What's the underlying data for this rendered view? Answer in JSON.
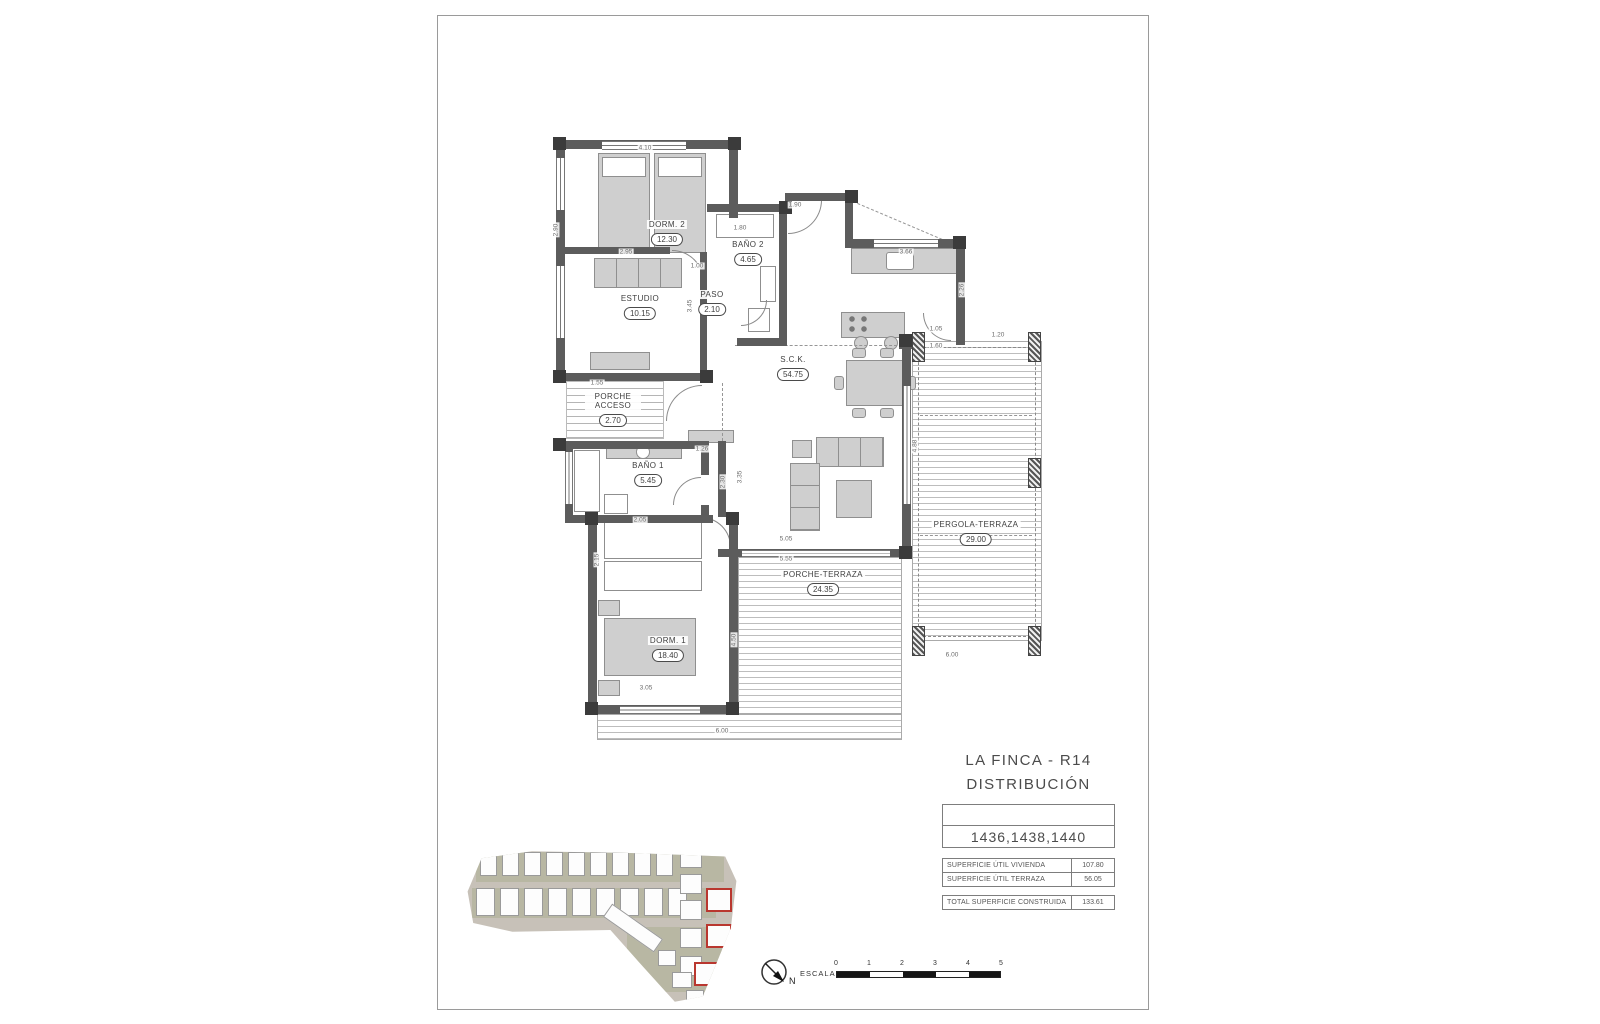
{
  "document": {
    "project_title": "LA FINCA - R14",
    "sheet_subtitle": "DISTRIBUCIÓN",
    "plot_numbers": "1436,1438,1440",
    "area_table": [
      {
        "label": "SUPERFICIE ÚTIL VIVIENDA",
        "value": "107.80"
      },
      {
        "label": "SUPERFICIE ÚTIL TERRAZA",
        "value": "56.05"
      }
    ],
    "total_row": {
      "label": "TOTAL SUPERFICIE CONSTRUIDA",
      "value": "133.61"
    },
    "scale_bar": {
      "label": "ESCALA",
      "north": "N",
      "ticks": [
        "0",
        "1",
        "2",
        "3",
        "4",
        "5"
      ]
    }
  },
  "plan": {
    "rooms": [
      {
        "name": "DORM. 2",
        "area": "12.30"
      },
      {
        "name": "BAÑO 2",
        "area": "4.65"
      },
      {
        "name": "ESTUDIO",
        "area": "10.15"
      },
      {
        "name": "PASO",
        "area": "2.10"
      },
      {
        "name": "S.C.K.",
        "area": "54.75"
      },
      {
        "name": "BAÑO 1",
        "area": "5.45"
      },
      {
        "name": "PORCHE ACCESO",
        "area": "2.70"
      },
      {
        "name": "DORM. 1",
        "area": "18.40"
      },
      {
        "name": "PORCHE-TERRAZA",
        "area": "24.35"
      },
      {
        "name": "PERGOLA-TERRAZA",
        "area": "29.00"
      }
    ],
    "dimensions": [
      "4.10",
      "2.90",
      "1.90",
      "1.80",
      "1.00",
      "2.95",
      "3.45",
      "3.66",
      "1.05",
      "2.26",
      "1.60",
      "1.20",
      "1.55",
      "1.26",
      "2.30",
      "5.05",
      "5.55",
      "3.35",
      "4.88",
      "2.05",
      "2.15",
      "3.05",
      "4.50",
      "6.00",
      "6.00"
    ]
  }
}
